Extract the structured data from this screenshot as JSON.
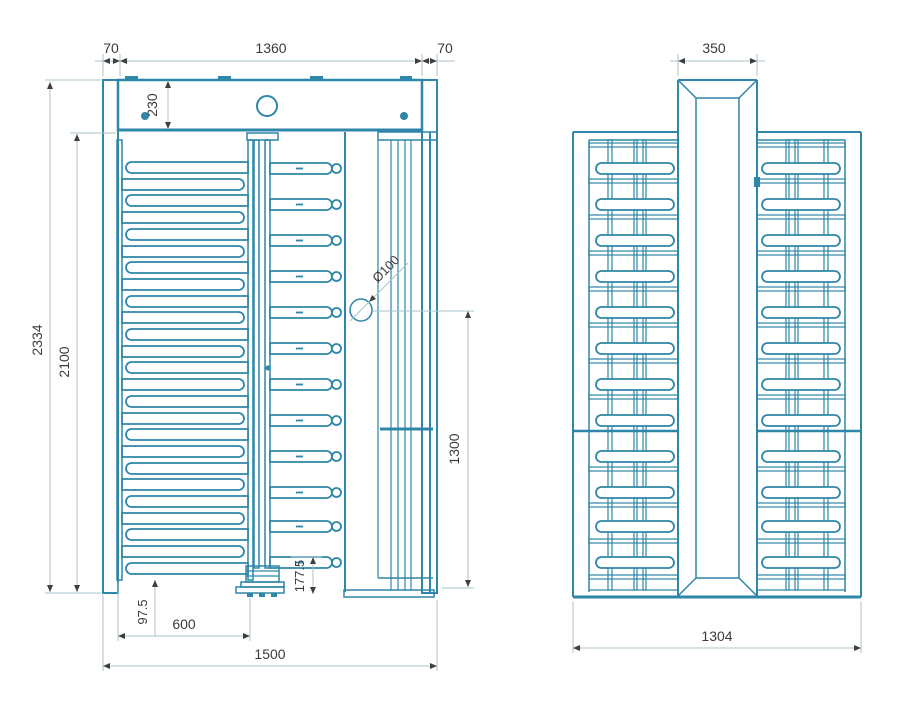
{
  "colors": {
    "line": "#2e86a8",
    "dim_line": "#a8c6cc",
    "arrow": "#3f3f3f",
    "text": "#3b3b3b",
    "background": "#ffffff"
  },
  "front_view": {
    "dims": {
      "left_post_width": "70",
      "frame_width": "1360",
      "right_post_width": "70",
      "header_height": "230",
      "overall_height": "2334",
      "inner_height": "2100",
      "rotor_hub_diameter": "Ø100",
      "side_panel_height": "1300",
      "arm_bottom_clearance": "177.5",
      "comb_bottom_clearance": "97.5",
      "comb_width": "600",
      "overall_width": "1500"
    }
  },
  "side_view": {
    "dims": {
      "column_width": "350",
      "overall_depth": "1304"
    }
  }
}
